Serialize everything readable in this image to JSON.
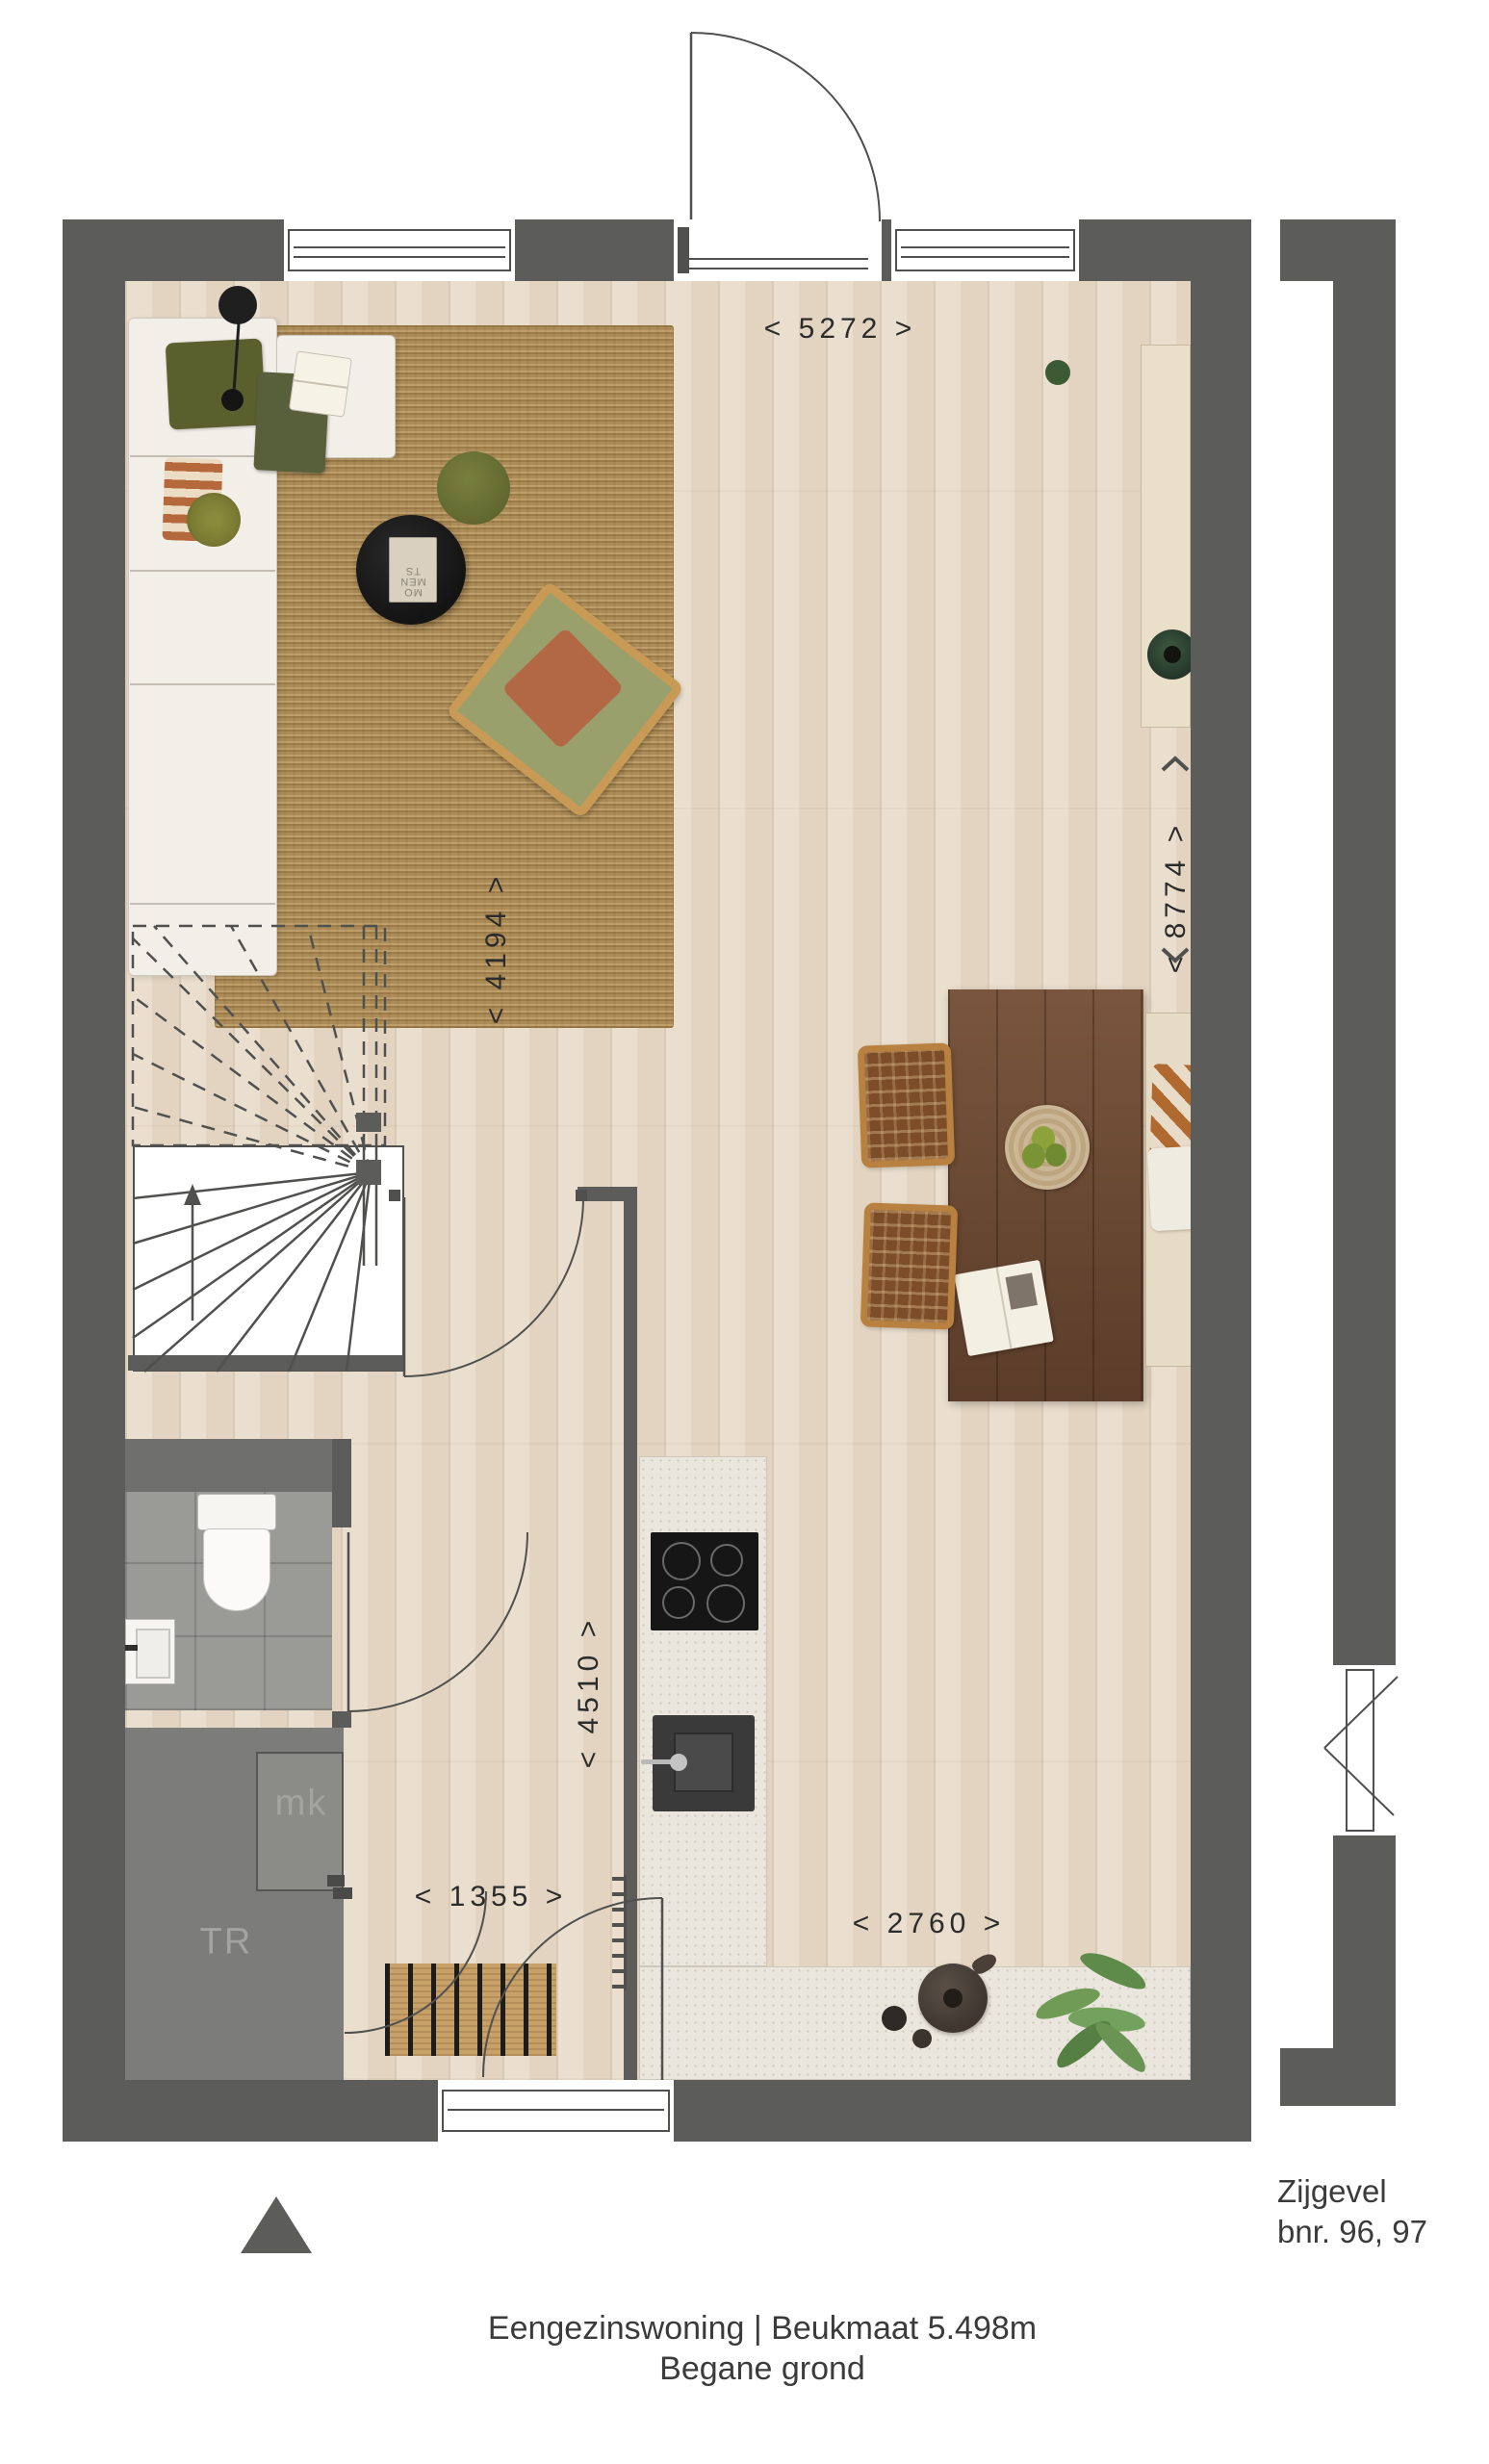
{
  "captions": {
    "line1": "Eengezinswoning | Beukmaat 5.498m",
    "line2": "Begane grond"
  },
  "side_label": {
    "line1": "Zijgevel",
    "line2": "bnr. 96, 97"
  },
  "room_labels": {
    "mk": "mk",
    "tr": "TR"
  },
  "dims": {
    "top_width": "< 5272 >",
    "living_depth": "< 4194 >",
    "total_depth": "< 8774 >",
    "kitchen_depth": "< 4510 >",
    "hall_width": "< 1355 >",
    "kitchen_width": "< 2760 >"
  },
  "decor": {
    "coffee_table_book": "MO\nMEN\nTS"
  },
  "colors": {
    "wall": "#5c5c5a",
    "storage_block": "#7c7c7a",
    "floor_wood": "#e8dbc8",
    "tile_gray": "#9a9a97",
    "rug_jute": "#b5935c",
    "counter": "#ebe6dd",
    "accent_olive": "#5f642f",
    "accent_terracotta": "#b26844",
    "table_wood": "#6e4a33"
  }
}
